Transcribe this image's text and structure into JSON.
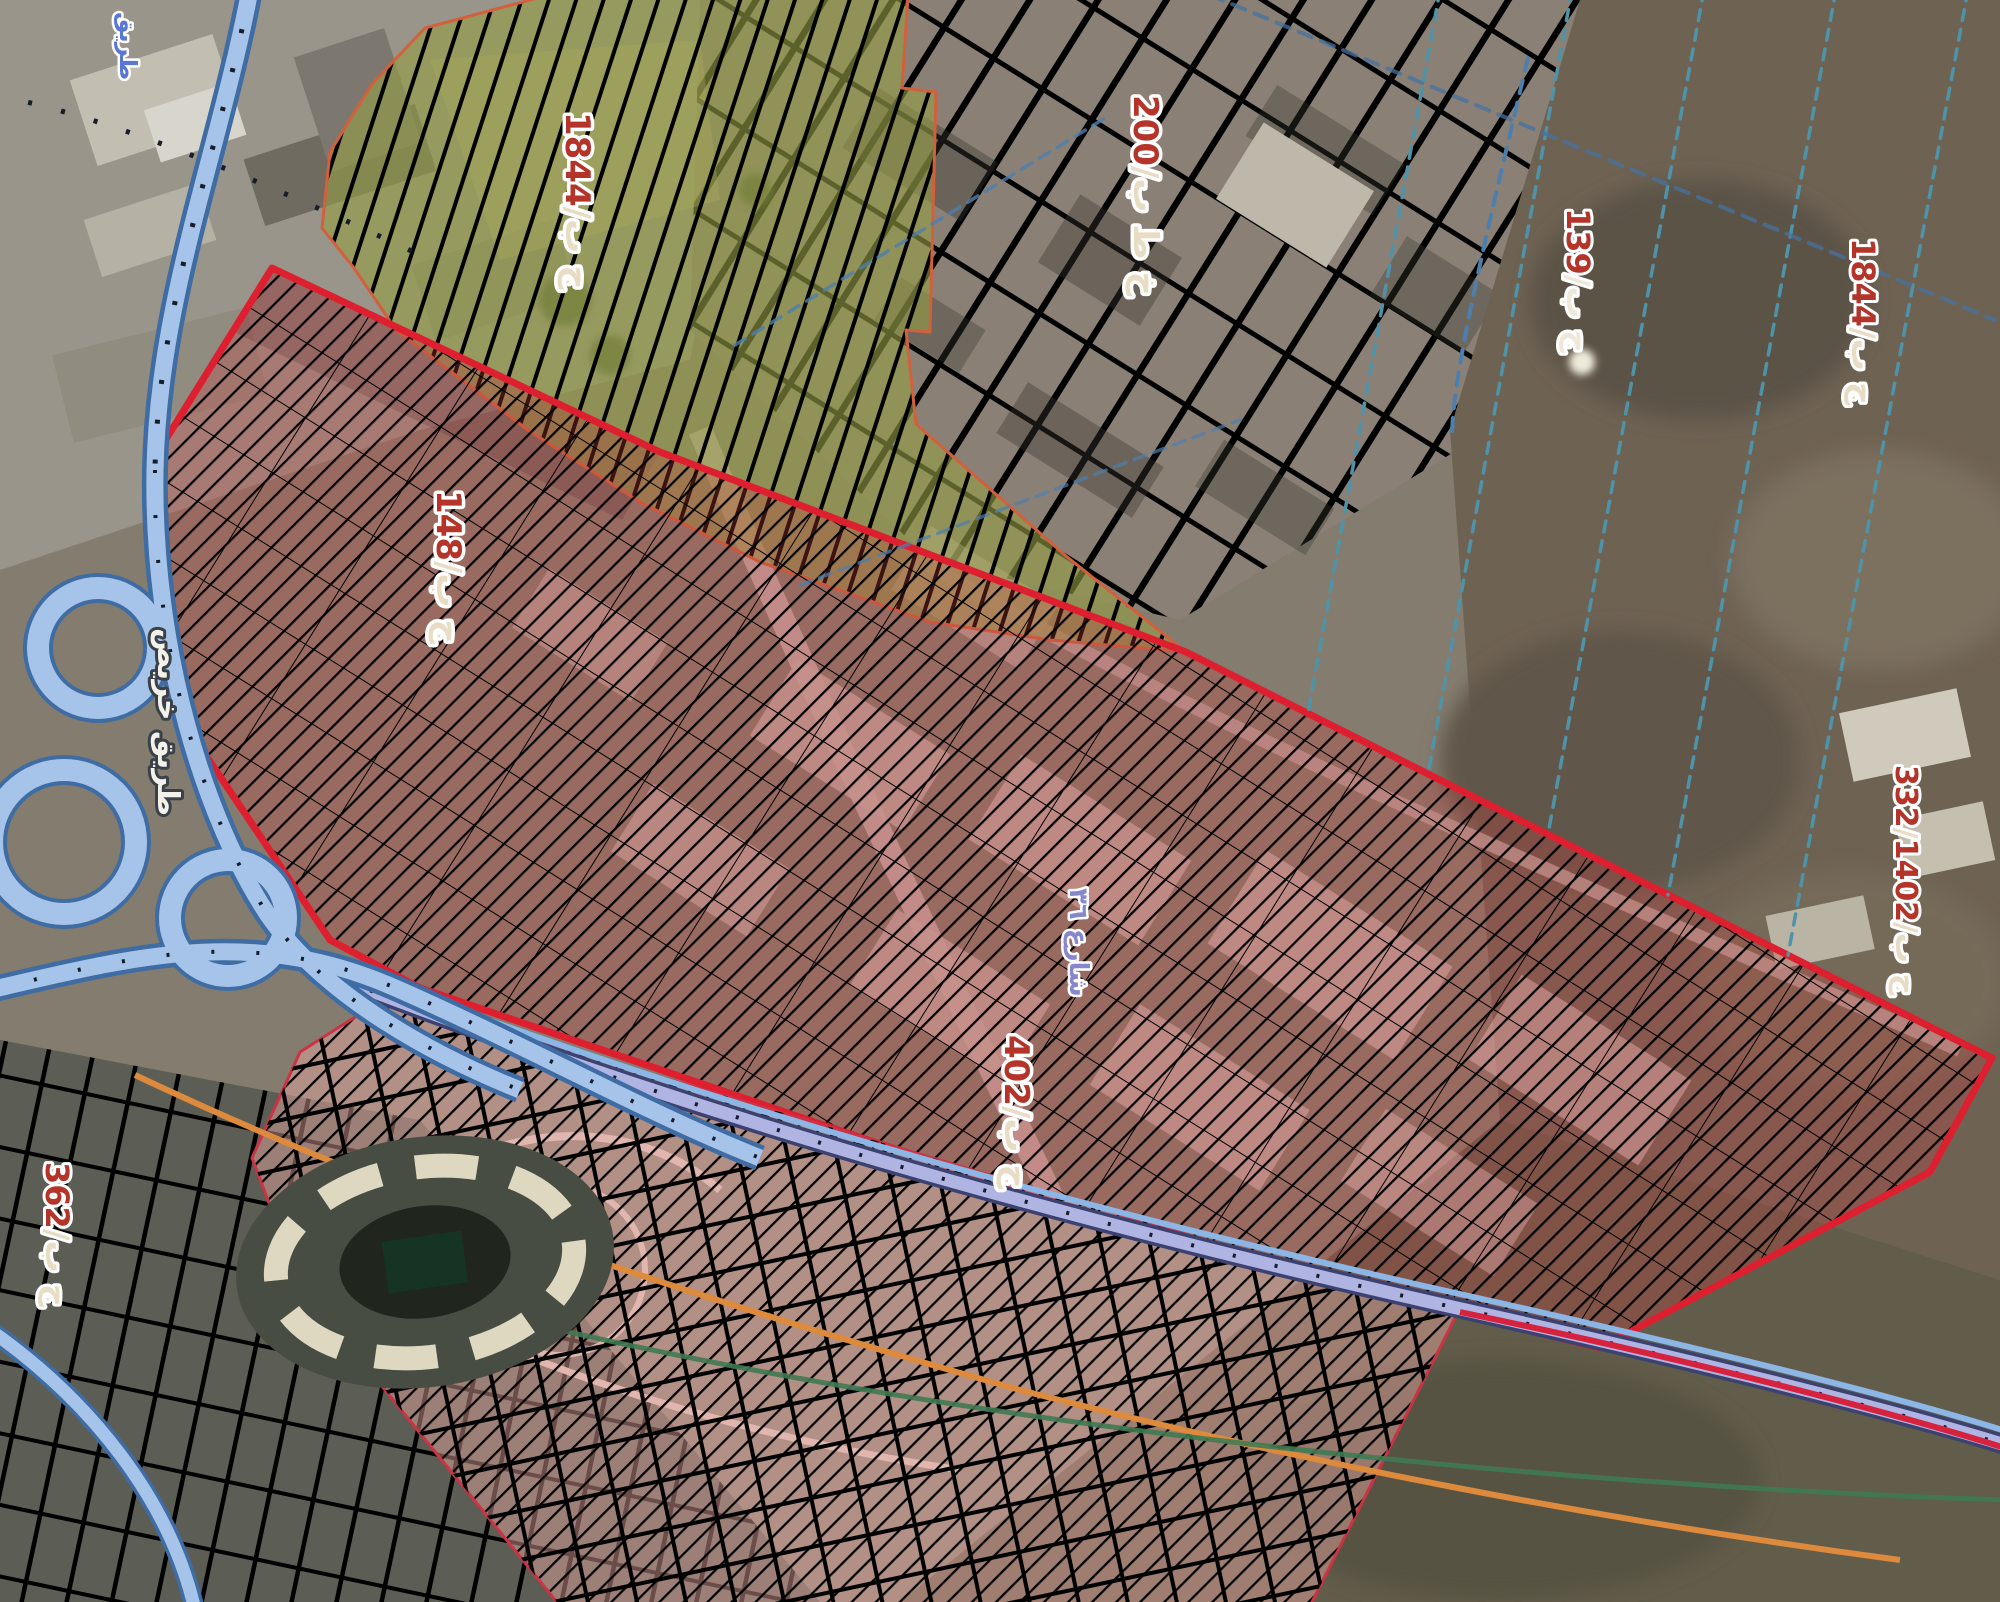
{
  "map": {
    "type": "satellite-imagery-with-zoning-overlay",
    "palette": {
      "olive_zone_fill": "rgba(148,156,70,0.62)",
      "olive_zone_border": "#d2603c",
      "red_zone_fill": "rgba(198,62,62,0.30)",
      "red_zone_border": "#de1f30",
      "pink_zone_fill": "rgba(235,168,162,0.45)",
      "pink_zone_border": "#cc3344",
      "highway_fill": "#a6c4ea",
      "highway_casing": "#3f6ca3",
      "rail_corridor": "#b0b4e2",
      "orange_route": "#dd8a3c",
      "green_route": "#3f7a52",
      "teal_parcel_line": "#4f93a8",
      "label_number_red": "#b5342a",
      "label_suffix_cream": "#e8dcc4"
    },
    "zones": [
      {
        "id": "zone-olive-plan-1844",
        "points": "425,28 545,-4 908,-4 902,88 936,92 930,332 906,330 916,424 1066,556 1186,652 1050,640 930,622 760,562 640,502 528,430 396,330 354,268 322,228 330,152 372,84",
        "fill": "rgba(148,156,70,0.62)",
        "hatch_pattern": "hatchSteep",
        "hatch_color": "rgba(196,74,53,0.75)",
        "border": "#d2603c",
        "border_width": 3
      },
      {
        "id": "zone-red-study-area",
        "points": "272,268 660,452 1186,652 1992,1058 1930,1172 1600,1348 1205,1252 820,1124 420,988 330,940 170,702 158,452",
        "fill": "rgba(198,62,62,0.30)",
        "hatch_pattern": "hatch45",
        "hatch_color": "rgba(205,50,55,0.55)",
        "grid_color": "rgba(190,45,50,0.5)",
        "border": "#de1f30",
        "border_width": 7
      },
      {
        "id": "zone-pink-suburb",
        "points": "388,996 800,1118 1205,1240 1458,1312 1310,1606 560,1606 432,1448 300,1285 252,1158 300,1052",
        "fill": "rgba(235,168,162,0.45)",
        "hatch_pattern": "hatch45",
        "hatch_color": "rgba(215,120,115,0.35)",
        "border": "#cc3344",
        "border_width": 3
      }
    ],
    "region_labels": [
      {
        "id": "plan-label-1844-olive",
        "x": 566,
        "y": 112,
        "rotation": 90,
        "font_size": 34,
        "parts": [
          {
            "text": "1844",
            "color": "#b5342a"
          },
          {
            "text": "/ج ب",
            "color": "#e8dcc4"
          }
        ]
      },
      {
        "id": "plan-label-200",
        "x": 1134,
        "y": 95,
        "rotation": 90,
        "font_size": 34,
        "parts": [
          {
            "text": "200",
            "color": "#b5342a"
          },
          {
            "text": "/خ ط ب",
            "color": "#e8dcc4"
          }
        ]
      },
      {
        "id": "plan-label-139",
        "x": 1567,
        "y": 208,
        "rotation": 90,
        "font_size": 32,
        "parts": [
          {
            "text": "139",
            "color": "#b5342a"
          },
          {
            "text": "/ج ب",
            "color": "#eee8da"
          }
        ]
      },
      {
        "id": "plan-label-1844-east",
        "x": 1852,
        "y": 238,
        "rotation": 90,
        "font_size": 32,
        "parts": [
          {
            "text": "1844",
            "color": "#b5342a"
          },
          {
            "text": "/ج ب",
            "color": "#e8dcc4"
          }
        ]
      },
      {
        "id": "plan-label-148",
        "x": 437,
        "y": 490,
        "rotation": 90,
        "font_size": 34,
        "parts": [
          {
            "text": "148",
            "color": "#b5342a"
          },
          {
            "text": "/ج ب",
            "color": "#e8dcc4"
          }
        ]
      },
      {
        "id": "plan-label-332",
        "x": 1896,
        "y": 765,
        "rotation": 90,
        "font_size": 30,
        "parts": [
          {
            "text": "332",
            "color": "#b5342a"
          },
          {
            "text": "/ج ب/",
            "color": "#e8dcc4"
          },
          {
            "text": "1402",
            "color": "#b5342a"
          }
        ]
      },
      {
        "id": "plan-label-402",
        "x": 1005,
        "y": 1035,
        "rotation": 90,
        "font_size": 34,
        "parts": [
          {
            "text": "402",
            "color": "#b5342a"
          },
          {
            "text": "/ج ب",
            "color": "#e8dcc4"
          }
        ]
      },
      {
        "id": "plan-label-362",
        "x": 46,
        "y": 1162,
        "rotation": 90,
        "font_size": 32,
        "parts": [
          {
            "text": "362",
            "color": "#b5342a"
          },
          {
            "text": "/ج ب",
            "color": "#e8dcc4"
          }
        ]
      },
      {
        "id": "road-label-khurais",
        "x": 158,
        "y": 628,
        "rotation": 90,
        "font_size": 30,
        "halo": "#3a4148",
        "parts": [
          {
            "text": "طريق خريص",
            "color": "#f4f1ea"
          }
        ]
      },
      {
        "id": "street-label-blue",
        "x": 1070,
        "y": 888,
        "rotation": 90,
        "font_size": 26,
        "halo": "#ffffff",
        "parts": [
          {
            "text": "شارع ٣٦",
            "color": "#8687cd"
          }
        ]
      },
      {
        "id": "road-label-top-left",
        "x": 120,
        "y": 12,
        "rotation": 90,
        "font_size": 24,
        "halo": "#ffffff",
        "parts": [
          {
            "text": "طريق",
            "color": "#5b77d6"
          }
        ]
      }
    ]
  }
}
